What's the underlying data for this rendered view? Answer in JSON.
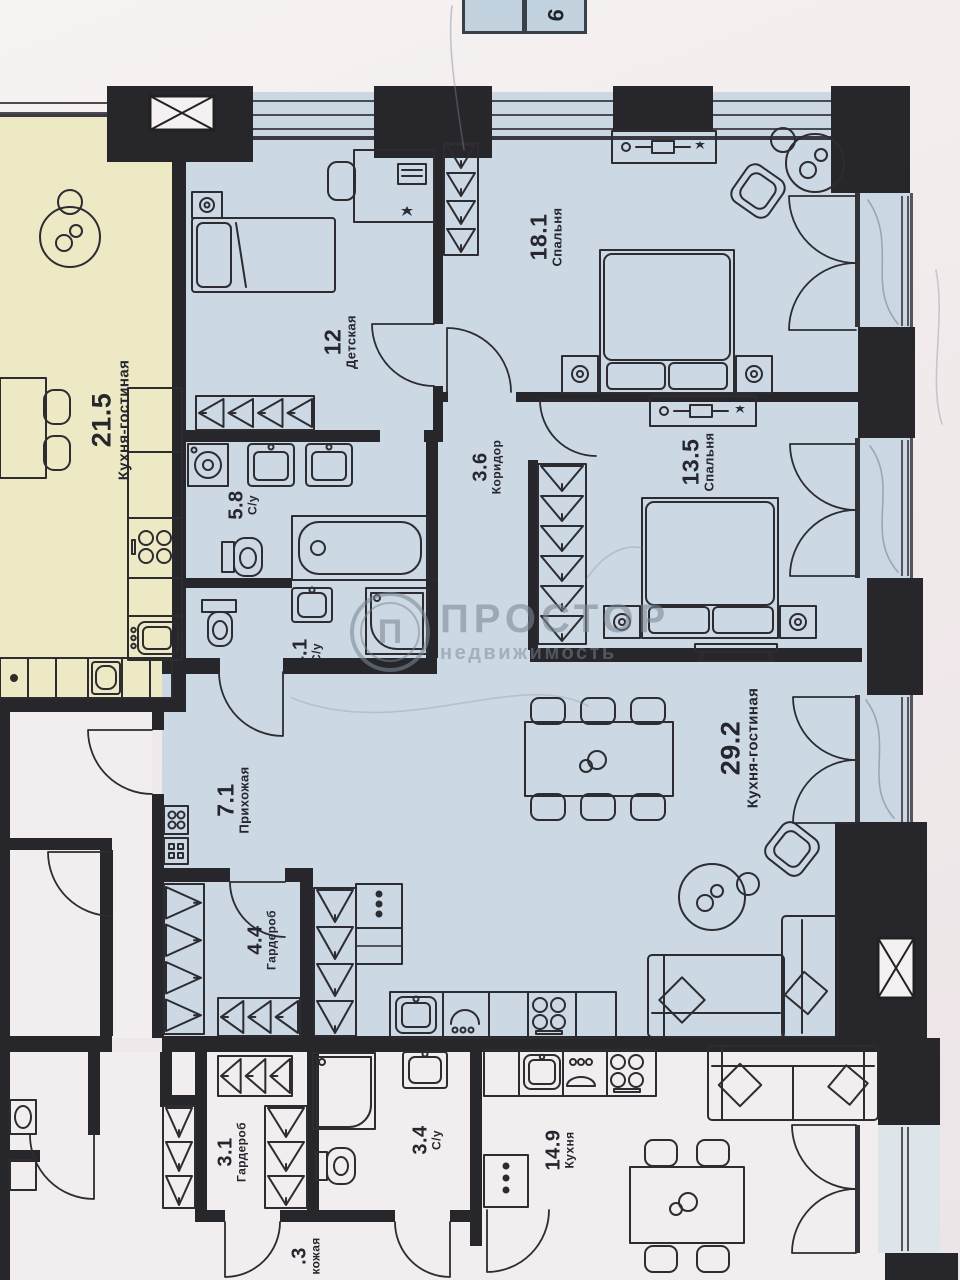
{
  "floor_badge": {
    "cells": [
      "",
      "9"
    ]
  },
  "watermark": {
    "name": "ПРОСТОР",
    "subtitle": "недвижимость",
    "logo_letter": "П"
  },
  "rooms": [
    {
      "id": "neighbor-kitchen-living",
      "area": "21.5",
      "name": "Кухня-гостиная"
    },
    {
      "id": "kids-room",
      "area": "12",
      "name": "Детская"
    },
    {
      "id": "bedroom-1",
      "area": "18.1",
      "name": "Спальня"
    },
    {
      "id": "corridor",
      "area": "3.6",
      "name": "Коридор"
    },
    {
      "id": "bathroom-1",
      "area": "5.8",
      "name": "С/у"
    },
    {
      "id": "bathroom-2",
      "area": "4.1",
      "name": "С/у"
    },
    {
      "id": "bedroom-2",
      "area": "13.5",
      "name": "Спальня"
    },
    {
      "id": "hallway",
      "area": "7.1",
      "name": "Прихожая"
    },
    {
      "id": "wardrobe",
      "area": "4.4",
      "name": "Гардероб"
    },
    {
      "id": "kitchen-living",
      "area": "29.2",
      "name": "Кухня-гостиная"
    },
    {
      "id": "lower-wardrobe",
      "area": "3.1",
      "name": "Гардероб"
    },
    {
      "id": "lower-bathroom",
      "area": "3.4",
      "name": "С/у"
    },
    {
      "id": "lower-kitchen",
      "area": "14.9",
      "name": "Кухня"
    },
    {
      "id": "lower-hallway-cut",
      "area": ".3",
      "name": "кожая"
    }
  ]
}
